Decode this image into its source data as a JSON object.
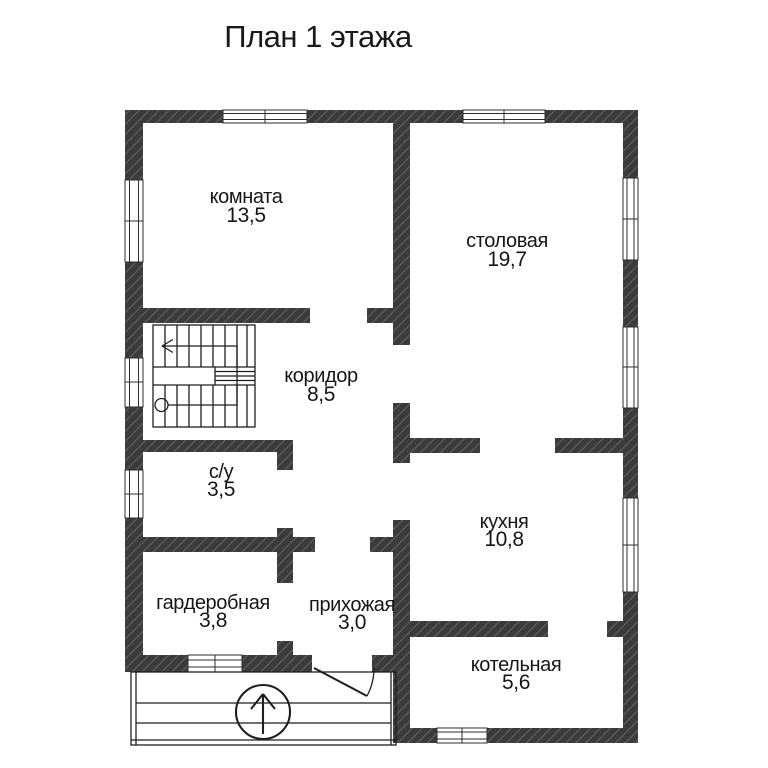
{
  "title": "План 1 этажа",
  "rooms": [
    {
      "id": "komnata",
      "name": "комната",
      "area": "13,5"
    },
    {
      "id": "stolovaya",
      "name": "столовая",
      "area": "19,7"
    },
    {
      "id": "koridor",
      "name": "коридор",
      "area": "8,5"
    },
    {
      "id": "su",
      "name": "с/у",
      "area": "3,5"
    },
    {
      "id": "kuhnya",
      "name": "кухня",
      "area": "10,8"
    },
    {
      "id": "garderobnaya",
      "name": "гардеробная",
      "area": "3,8"
    },
    {
      "id": "prihozhaya",
      "name": "прихожая",
      "area": "3,0"
    },
    {
      "id": "kotelnaya",
      "name": "котельная",
      "area": "5,6"
    }
  ],
  "colors": {
    "wall": "#3b3b3b",
    "wall_hatch": "#5d5d5d",
    "line": "#1f1f1f",
    "text": "#161616",
    "background": "#ffffff"
  }
}
